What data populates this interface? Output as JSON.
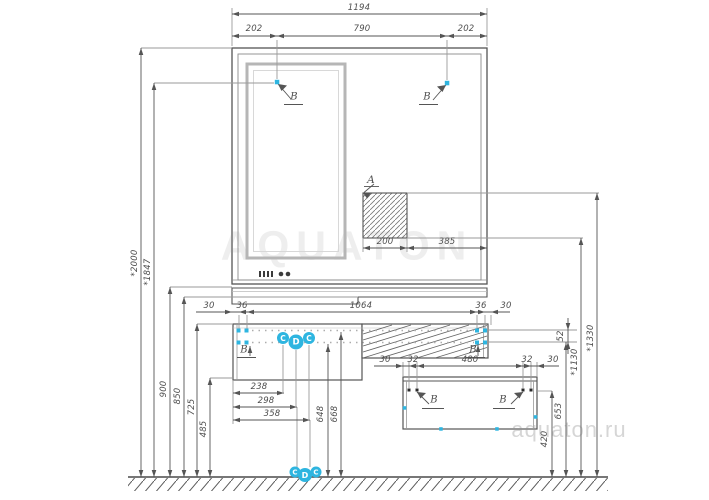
{
  "watermarks": {
    "center": "AQUATON",
    "corner": "aquaton.ru"
  },
  "colors": {
    "accent_blue": "#2eb5e0",
    "line": "#555555",
    "frame_gray": "#b6b6b6",
    "watermark": "#ececec"
  },
  "callouts": {
    "niche": "A",
    "wall_mount": "B",
    "floor_c": "C",
    "floor_d": "D"
  },
  "dims": {
    "top_overall": "1194",
    "top_left": "202",
    "top_mid": "790",
    "top_right": "202",
    "left_h1": "*2000",
    "left_h2": "*1847",
    "left_h3": "900",
    "left_h4": "850",
    "left_h5": "725",
    "left_h6": "485",
    "niche_w": "200",
    "niche_off": "385",
    "van_30l": "30",
    "van_36l": "36",
    "van_mid": "1064",
    "van_36r": "36",
    "van_30r": "30",
    "low_238": "238",
    "low_298": "298",
    "low_358": "358",
    "low_648": "648",
    "low_668": "668",
    "cab_30l": "30",
    "cab_32l": "32",
    "cab_mid": "480",
    "cab_32r": "32",
    "cab_30r": "30",
    "r_52": "52",
    "r_1130": "*1130",
    "r_1330": "*1330",
    "r_653": "653",
    "r_420": "420"
  }
}
